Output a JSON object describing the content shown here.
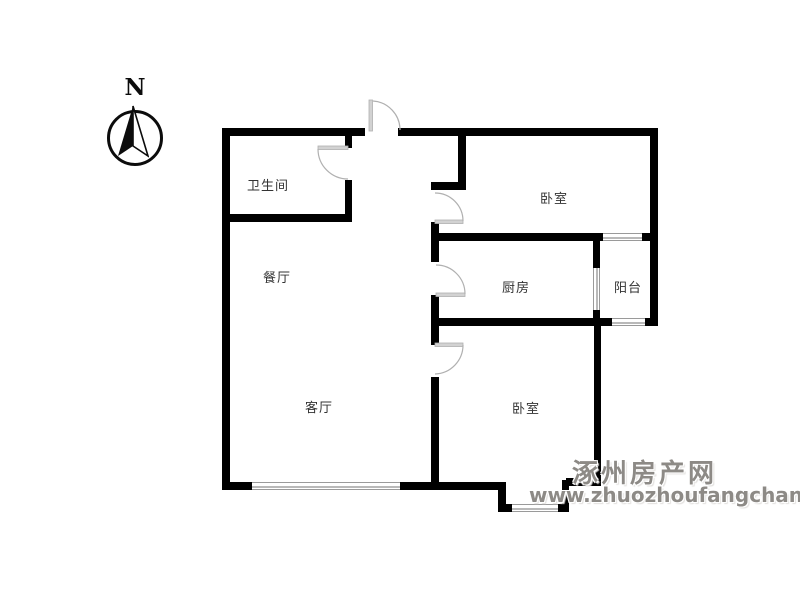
{
  "compass": {
    "label": "N"
  },
  "rooms": [
    {
      "id": "bathroom",
      "label": "卫生间"
    },
    {
      "id": "dining-room",
      "label": "餐厅"
    },
    {
      "id": "living-room",
      "label": "客厅"
    },
    {
      "id": "kitchen",
      "label": "厨房"
    },
    {
      "id": "balcony",
      "label": "阳台"
    },
    {
      "id": "bedroom-north",
      "label": "卧室"
    },
    {
      "id": "bedroom-south",
      "label": "卧室"
    }
  ],
  "watermark": {
    "site_name": "涿州房产网",
    "url": "www.zhuozhoufangchan.com"
  },
  "colors": {
    "wall": "#000000",
    "door": "#b0b0b0",
    "window_line": "#9a9a9a",
    "window_line_inner": "#b9b9b9",
    "label": "#333333",
    "watermark": "#8d8a86"
  }
}
